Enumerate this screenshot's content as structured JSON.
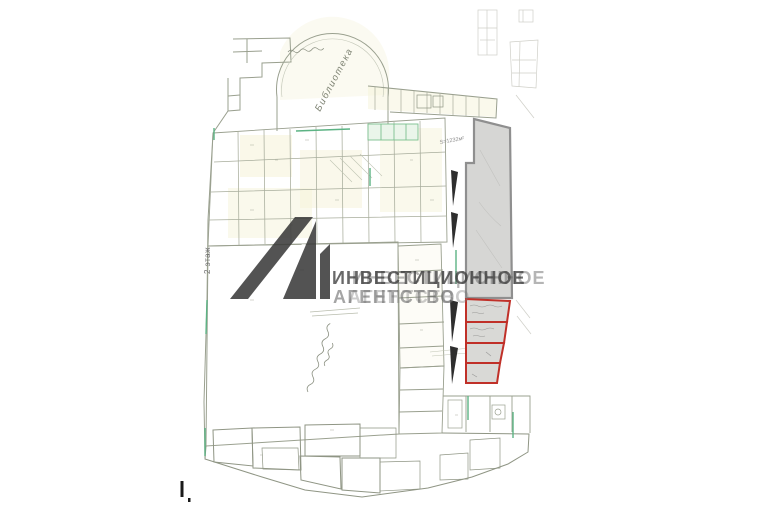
{
  "watermark": {
    "logo_icon": "investment-agency-logo",
    "line1": "ИНВЕСТИЦИОННОЕ",
    "line2": "АГЕНТСТВО"
  },
  "plan_labels": {
    "library": "Библиотека",
    "floor": "2 этаж",
    "area": "S=1232м²"
  },
  "red_outline": {
    "units_count": 4
  },
  "colors": {
    "highlight_red": "#c03028",
    "parcel_fill": "#d6d6d4",
    "parcel_border": "#8f8f8f",
    "watermark_gray": "#3c3c3c",
    "plan_line": "#9aa08f",
    "green_accent": "#5cb384",
    "room_fill": "#f6f3da",
    "background": "#ffffff"
  }
}
